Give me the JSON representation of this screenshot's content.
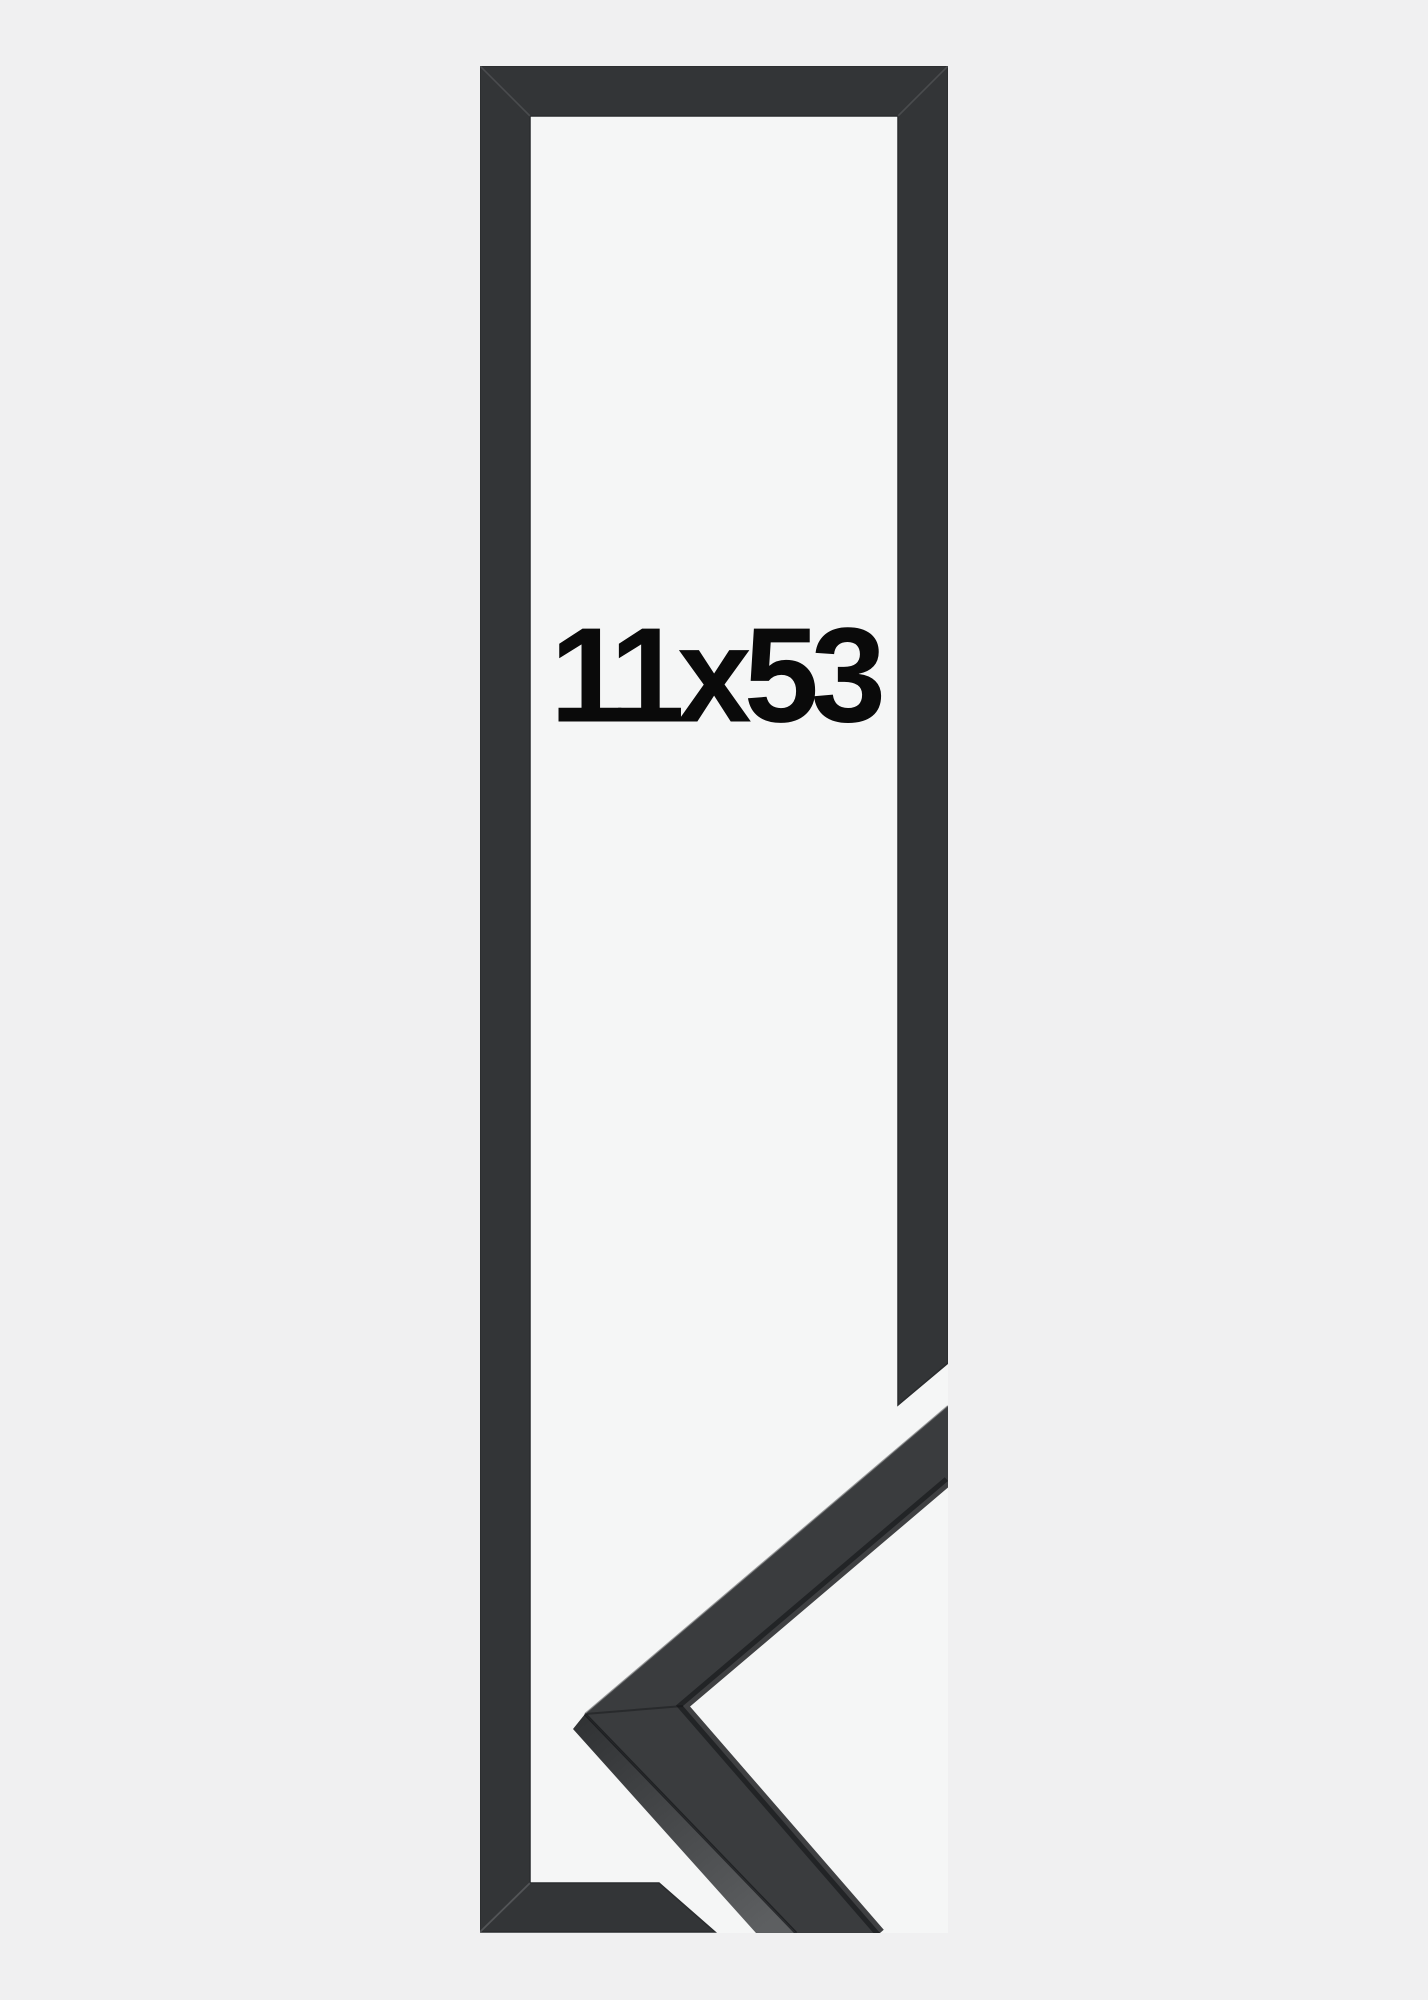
{
  "page": {
    "background": "#f0f0f1"
  },
  "product_image": {
    "size_label": "11x53",
    "colors": {
      "photo_background": "#f5f6f6",
      "frame_face": "#333537",
      "frame_edge": "#2a2c2e",
      "sample_face": "#3a3c3e",
      "sample_side_start": "#303234",
      "sample_side_end": "#5d5f61",
      "label_text": "#0a0a0a"
    }
  }
}
